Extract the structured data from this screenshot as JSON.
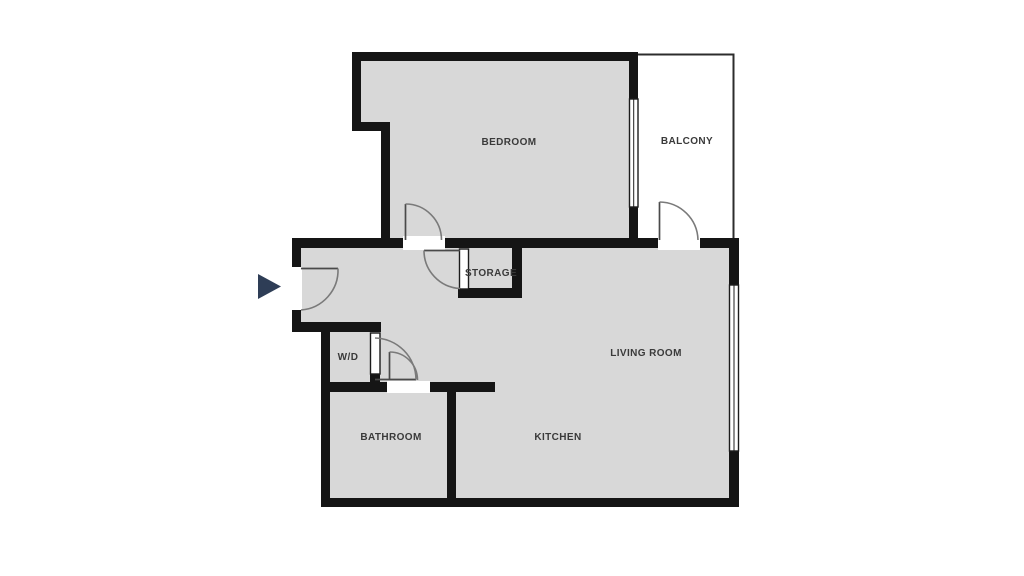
{
  "colors": {
    "background": "#ffffff",
    "room_fill": "#d8d8d8",
    "balcony_fill": "#ffffff",
    "wall": "#151515",
    "outline": "#2c2c2c",
    "window_frame": "#1c1c1c",
    "door_leaf": "#4a4a4a",
    "door_swing": "#7a7a7a",
    "label_text": "#3a3a3a",
    "entrance_arrow": "#2e3d56"
  },
  "floorplan": {
    "rooms": {
      "bedroom": {
        "label": "BEDROOM"
      },
      "balcony": {
        "label": "BALCONY"
      },
      "storage": {
        "label": "STORAGE"
      },
      "living_room": {
        "label": "LIVING ROOM"
      },
      "washer_dryer": {
        "label": "W/D"
      },
      "bathroom": {
        "label": "BATHROOM"
      },
      "kitchen": {
        "label": "KITCHEN"
      }
    },
    "entrance": {
      "icon": "right-pointing-triangle"
    }
  }
}
